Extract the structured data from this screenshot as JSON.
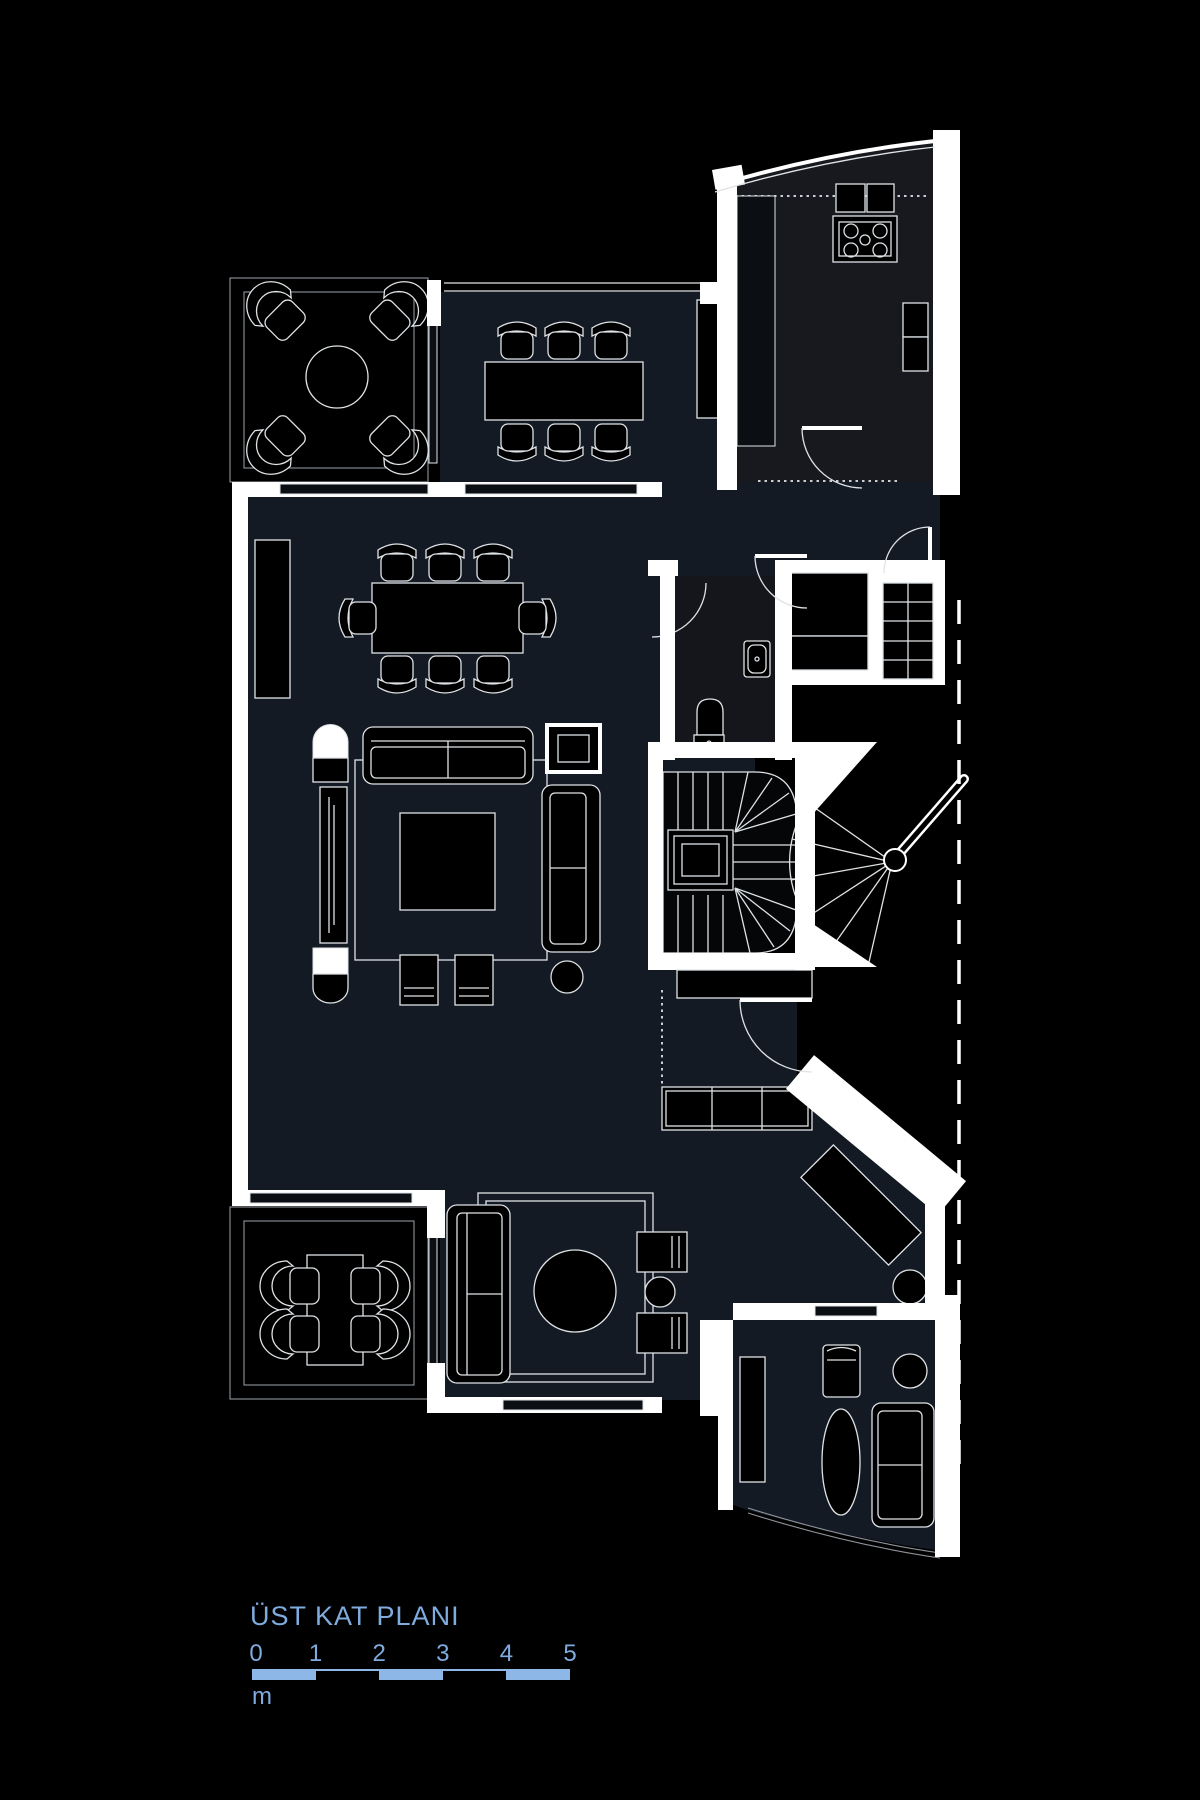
{
  "title": {
    "label": "ÜST KAT PLANI"
  },
  "scale_bar": {
    "tick_labels": [
      "0",
      "1",
      "2",
      "3",
      "4",
      "5"
    ],
    "unit_label": "m",
    "meters_total": 5,
    "filled_segments": [
      0,
      2,
      4
    ]
  },
  "colors": {
    "background": "#000000",
    "accent_blue": "#7fabdf",
    "bar_blue": "#8db7e7",
    "wall_white": "#ffffff",
    "line": "#dfe3e6",
    "room_fill": "#131a24",
    "kitchen_fill": "#17191e",
    "bath_fill": "#14161b"
  }
}
